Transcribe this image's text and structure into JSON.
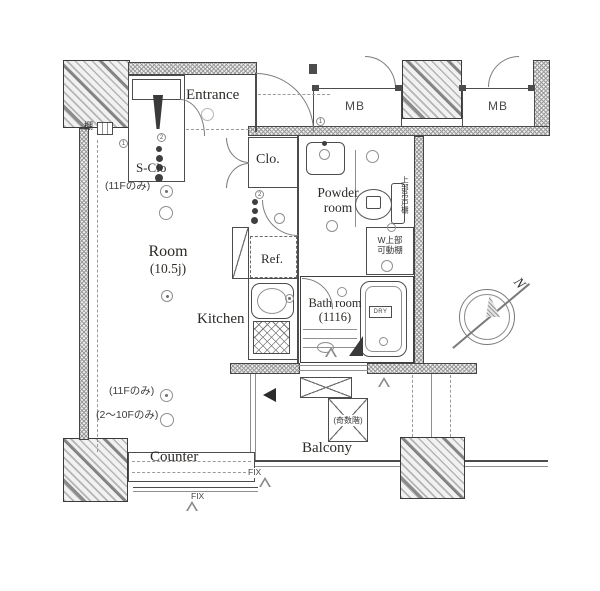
{
  "rooms": {
    "s_clo": "S-Clo",
    "entrance": "Entrance",
    "mb_left": "MB",
    "mb_right": "MB",
    "clo": "Clo.",
    "powder_line1": "Powder",
    "powder_line2": "room",
    "room_line1": "Room",
    "room_line2": "(10.5j)",
    "ref": "Ref.",
    "kitchen": "Kitchen",
    "bath_line1": "Bath room",
    "bath_line2": "(1116)",
    "counter": "Counter",
    "balcony": "Balcony"
  },
  "fixtures": {
    "washer_line1": "W上部",
    "washer_line2": "可動棚",
    "upper_cabinet": "上部吊戸棚",
    "shelf_label": "棚",
    "dry_label": "DRY"
  },
  "notes": {
    "floor11_a": "(11Fのみ)",
    "floor11_b": "(11Fのみ)",
    "floor2to10": "(2～10Fのみ)",
    "odd_floors": "(奇数階)",
    "fix_a": "FIX",
    "fix_b": "FIX",
    "marker1": "1",
    "marker2": "2",
    "marker3": "1",
    "marker4": "2"
  },
  "compass": {
    "north": "N"
  },
  "colors": {
    "line": "#3c3c3c",
    "wall_fill": "#ececec",
    "text": "#2e2b28",
    "dark": "#2d2d2d"
  }
}
